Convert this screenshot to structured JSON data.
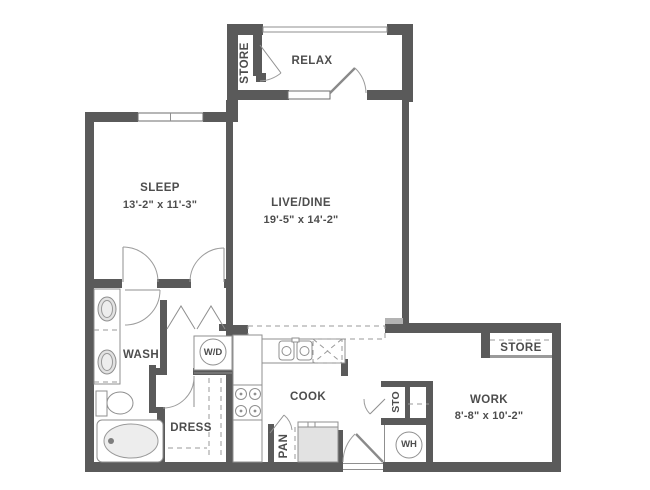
{
  "plan_title": "One-bedroom apartment floor plan",
  "colors": {
    "wall": "#5a5a5a",
    "fixture_outline": "#8f8f8f",
    "dashed_line": "#9a9a9a",
    "label_text": "#4d4d4d",
    "background": "#ffffff"
  },
  "rooms": {
    "relax": {
      "label": "RELAX"
    },
    "store_balcony": {
      "label": "STORE"
    },
    "sleep": {
      "label": "SLEEP",
      "dims": "13'-2\" x 11'-3\""
    },
    "live_dine": {
      "label": "LIVE/DINE",
      "dims": "19'-5\" x 14'-2\""
    },
    "wash": {
      "label": "WASH"
    },
    "laundry": {
      "label": "W/D"
    },
    "dress": {
      "label": "DRESS"
    },
    "cook": {
      "label": "COOK"
    },
    "pantry": {
      "label": "PAN"
    },
    "storage_hall": {
      "label": "STO"
    },
    "water_heater": {
      "label": "WH"
    },
    "work": {
      "label": "WORK",
      "dims": "8'-8\" x 10'-2\""
    },
    "store_work": {
      "label": "STORE"
    }
  }
}
